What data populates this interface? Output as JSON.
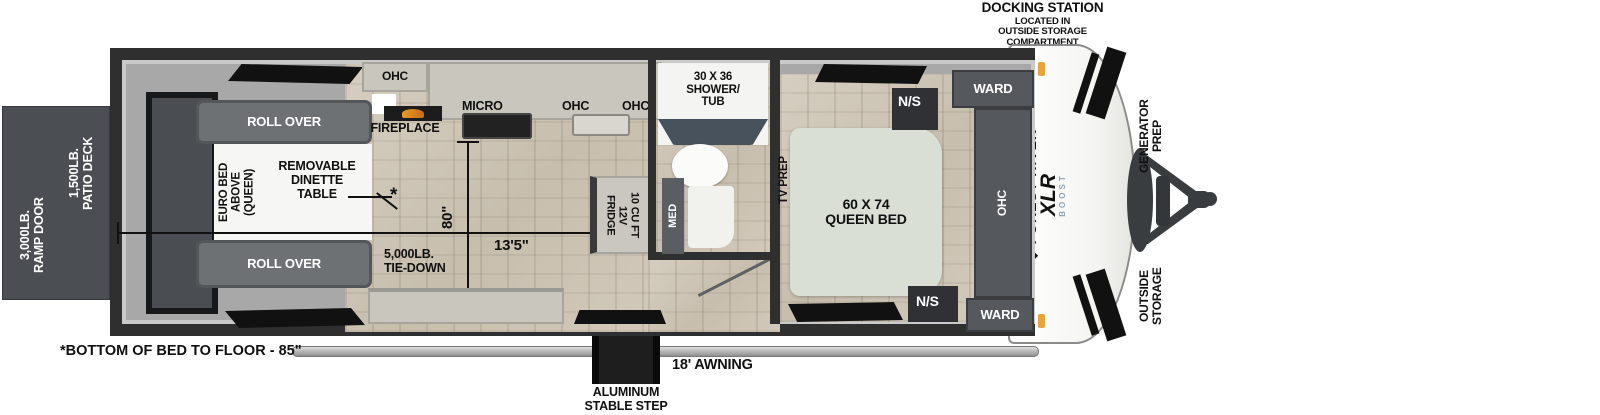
{
  "title": "travel trailer floorplan",
  "exterior": {
    "docking_station_heading": "DOCKING STATION",
    "docking_station_sub": "LOCATED IN\nOUTSIDE STORAGE\nCOMPARTMENT",
    "patio_deck": "1,500LB.\nPATIO DECK",
    "ramp_door": "3,000LB.\nRAMP DOOR",
    "generator_prep": "GENERATOR\nPREP",
    "outside_storage": "OUTSIDE\nSTORAGE",
    "awning": "18' AWNING",
    "step": "ALUMINUM\nSTABLE STEP",
    "bottom_note": "*BOTTOM OF BED TO FLOOR - 85\""
  },
  "brand": {
    "emblem": "◆",
    "name": "FOREST RIVER",
    "model": "XLR",
    "model_sub": "BOOST"
  },
  "garage": {
    "roll_over_top": "ROLL OVER",
    "roll_over_bottom": "ROLL OVER",
    "euro_bed": "EURO BED\nABOVE\n(QUEEN)",
    "dinette": "REMOVABLE\nDINETTE\nTABLE",
    "dinette_marker": "*",
    "tie_down": "5,000LB.\nTIE-DOWN",
    "dim_width": "80\"",
    "dim_length": "13'5\""
  },
  "kitchen": {
    "ohc_left": "OHC",
    "micro": "MICRO",
    "ohc_mid": "OHC",
    "ohc_right": "OHC",
    "fireplace": "FIREPLACE",
    "fridge": "10 CU FT\n12V\nFRIDGE"
  },
  "bath": {
    "shower": "30 X 36\nSHOWER/\nTUB",
    "med": "MED"
  },
  "bedroom": {
    "tv_prep": "TV PREP",
    "queen_bed": "60 X 74\nQUEEN BED",
    "ns_top": "N/S",
    "ns_bottom": "N/S",
    "ward_top": "WARD",
    "ward_bottom": "WARD",
    "ohc": "OHC"
  },
  "colors": {
    "wall": "#2f2f2f",
    "interior": "#a8a8a8",
    "counter": "#c8c6bd",
    "cabinet": "#55585c",
    "sofa": "#6e7174",
    "bed": "#dadfd6",
    "ramp_panel": "#4b4f54",
    "amber_light": "#e8a33d"
  }
}
